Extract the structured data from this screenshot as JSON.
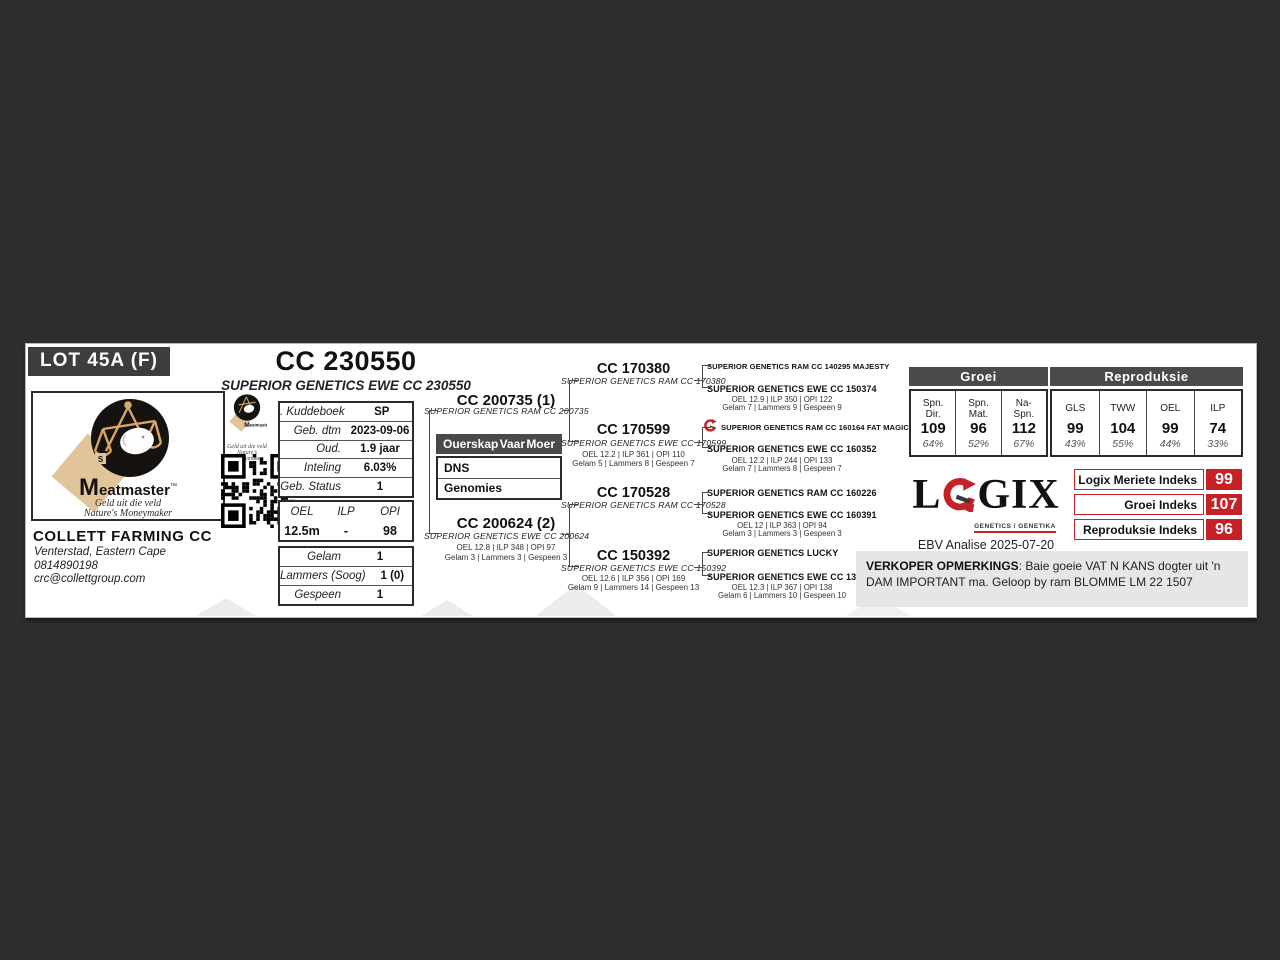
{
  "lot": {
    "label": "LOT 45A (F)"
  },
  "header": {
    "title": "CC 230550",
    "subtitle": "SUPERIOR GENETICS EWE CC 230550"
  },
  "brand": {
    "name": "Meatmaster",
    "tm": "™",
    "tagline1": "Geld uit die veld",
    "tagline2": "Nature's Moneymaker"
  },
  "seller": {
    "name": "COLLETT FARMING CC",
    "location": "Venterstad, Eastern Cape",
    "phone": "0814890198",
    "email": "crc@collettgroup.com"
  },
  "details": {
    "rows": [
      {
        "label": ". Kuddeboek",
        "value": "SP"
      },
      {
        "label": "Geb. dtm",
        "value": "2023-09-06"
      },
      {
        "label": "Oud.",
        "value": "1.9 jaar"
      },
      {
        "label": "Inteling",
        "value": "6.03%"
      },
      {
        "label": "Geb. Status",
        "value": "1"
      }
    ]
  },
  "production": {
    "headers": [
      "OEL",
      "ILP",
      "OPI"
    ],
    "values": [
      "12.5m",
      "-",
      "98"
    ]
  },
  "lambing": {
    "rows": [
      {
        "label": "Gelam",
        "value": "1"
      },
      {
        "label": "Lammers (Soog)",
        "value": "1 (0)"
      },
      {
        "label": "Gespeen",
        "value": "1"
      }
    ]
  },
  "parentage": {
    "title": "Ouerskap",
    "col_sire": "Vaar",
    "col_dam": "Moer",
    "rows": [
      "DNS",
      "Genomies"
    ]
  },
  "pedigree": {
    "sire": {
      "id": "CC 200735 (1)",
      "name": "SUPERIOR GENETICS RAM CC 200735"
    },
    "dam": {
      "id": "CC 200624 (2)",
      "name": "SUPERIOR GENETICS EWE CC 200624",
      "stats1": "OEL 12.8 | ILP 348 | OPI 97",
      "stats2": "Gelam 3 | Lammers 3 | Gespeen 3"
    },
    "grandparents": [
      {
        "id": "CC 170380",
        "name": "SUPERIOR GENETICS RAM CC 170380"
      },
      {
        "id": "CC 170599",
        "name": "SUPERIOR GENETICS EWE CC 170599",
        "stats1": "OEL 12.2 | ILP 361 | OPI 110",
        "stats2": "Gelam 5 | Lammers 8 | Gespeen 7"
      },
      {
        "id": "CC 170528",
        "name": "SUPERIOR GENETICS RAM CC 170528"
      },
      {
        "id": "CC 150392",
        "name": "SUPERIOR GENETICS EWE CC 150392",
        "stats1": "OEL 12.6 | ILP 356 | OPI 169",
        "stats2": "Gelam 9 | Lammers 14 | Gespeen 13"
      }
    ],
    "great_grandparents": [
      {
        "name": "SUPERIOR GENETICS RAM CC 140295 MAJESTY"
      },
      {
        "name": "SUPERIOR GENETICS EWE CC 150374",
        "stats1": "OEL 12.9 | ILP 350 | OPI 122",
        "stats2": "Gelam 7 | Lammers 9 | Gespeen 9"
      },
      {
        "name": "SUPERIOR GENETICS RAM CC 160164 FAT MAGIC",
        "icon": "logix-g-icon"
      },
      {
        "name": "SUPERIOR GENETICS EWE CC 160352",
        "stats1": "OEL 12.2 | ILP 244 | OPI 133",
        "stats2": "Gelam 7 | Lammers 8 | Gespeen 7"
      },
      {
        "name": "SUPERIOR GENETICS RAM CC 160226"
      },
      {
        "name": "SUPERIOR GENETICS EWE CC 160391",
        "stats1": "OEL 12 | ILP 363 | OPI 94",
        "stats2": "Gelam 3 | Lammers 3 | Gespeen 3"
      },
      {
        "name": "SUPERIOR GENETICS LUCKY"
      },
      {
        "name": "SUPERIOR GENETICS EWE CC 130210",
        "stats1": "OEL 12.3 | ILP 367 | OPI 138",
        "stats2": "Gelam 6 | Lammers 10 | Gespeen 10"
      }
    ]
  },
  "ebv": {
    "groei": {
      "title": "Groei",
      "columns": [
        {
          "label": "Spn.\nDir.",
          "value": "109",
          "accuracy": "64%"
        },
        {
          "label": "Spn.\nMat.",
          "value": "96",
          "accuracy": "52%"
        },
        {
          "label": "Na-\nSpn.",
          "value": "112",
          "accuracy": "67%"
        }
      ]
    },
    "repro": {
      "title": "Reproduksie",
      "columns": [
        {
          "label": "GLS",
          "value": "99",
          "accuracy": "43%"
        },
        {
          "label": "TWW",
          "value": "104",
          "accuracy": "55%"
        },
        {
          "label": "OEL",
          "value": "99",
          "accuracy": "44%"
        },
        {
          "label": "ILP",
          "value": "74",
          "accuracy": "33%"
        }
      ]
    },
    "logix": {
      "part_l": "L",
      "part_gix": "GIX",
      "caption": "GENETICS / GENETIKA"
    },
    "analysis_date": "EBV Analise 2025-07-20",
    "indexes": [
      {
        "label": "Logix Meriete Indeks",
        "value": "99"
      },
      {
        "label": "Groei Indeks",
        "value": "107"
      },
      {
        "label": "Reproduksie Indeks",
        "value": "96"
      }
    ]
  },
  "remarks": {
    "label": "VERKOPER OPMERKINGS",
    "text": ": Baie goeie VAT N KANS dogter uit 'n DAM IMPORTANT ma. Geloop by ram BLOMME LM 22 1507"
  },
  "colors": {
    "accent_red": "#c52127",
    "band_dark": "#2e2e2e",
    "header_bar": "#4a4a4a",
    "logo_tan": "#e2c49a",
    "watermark": "#ececec"
  }
}
